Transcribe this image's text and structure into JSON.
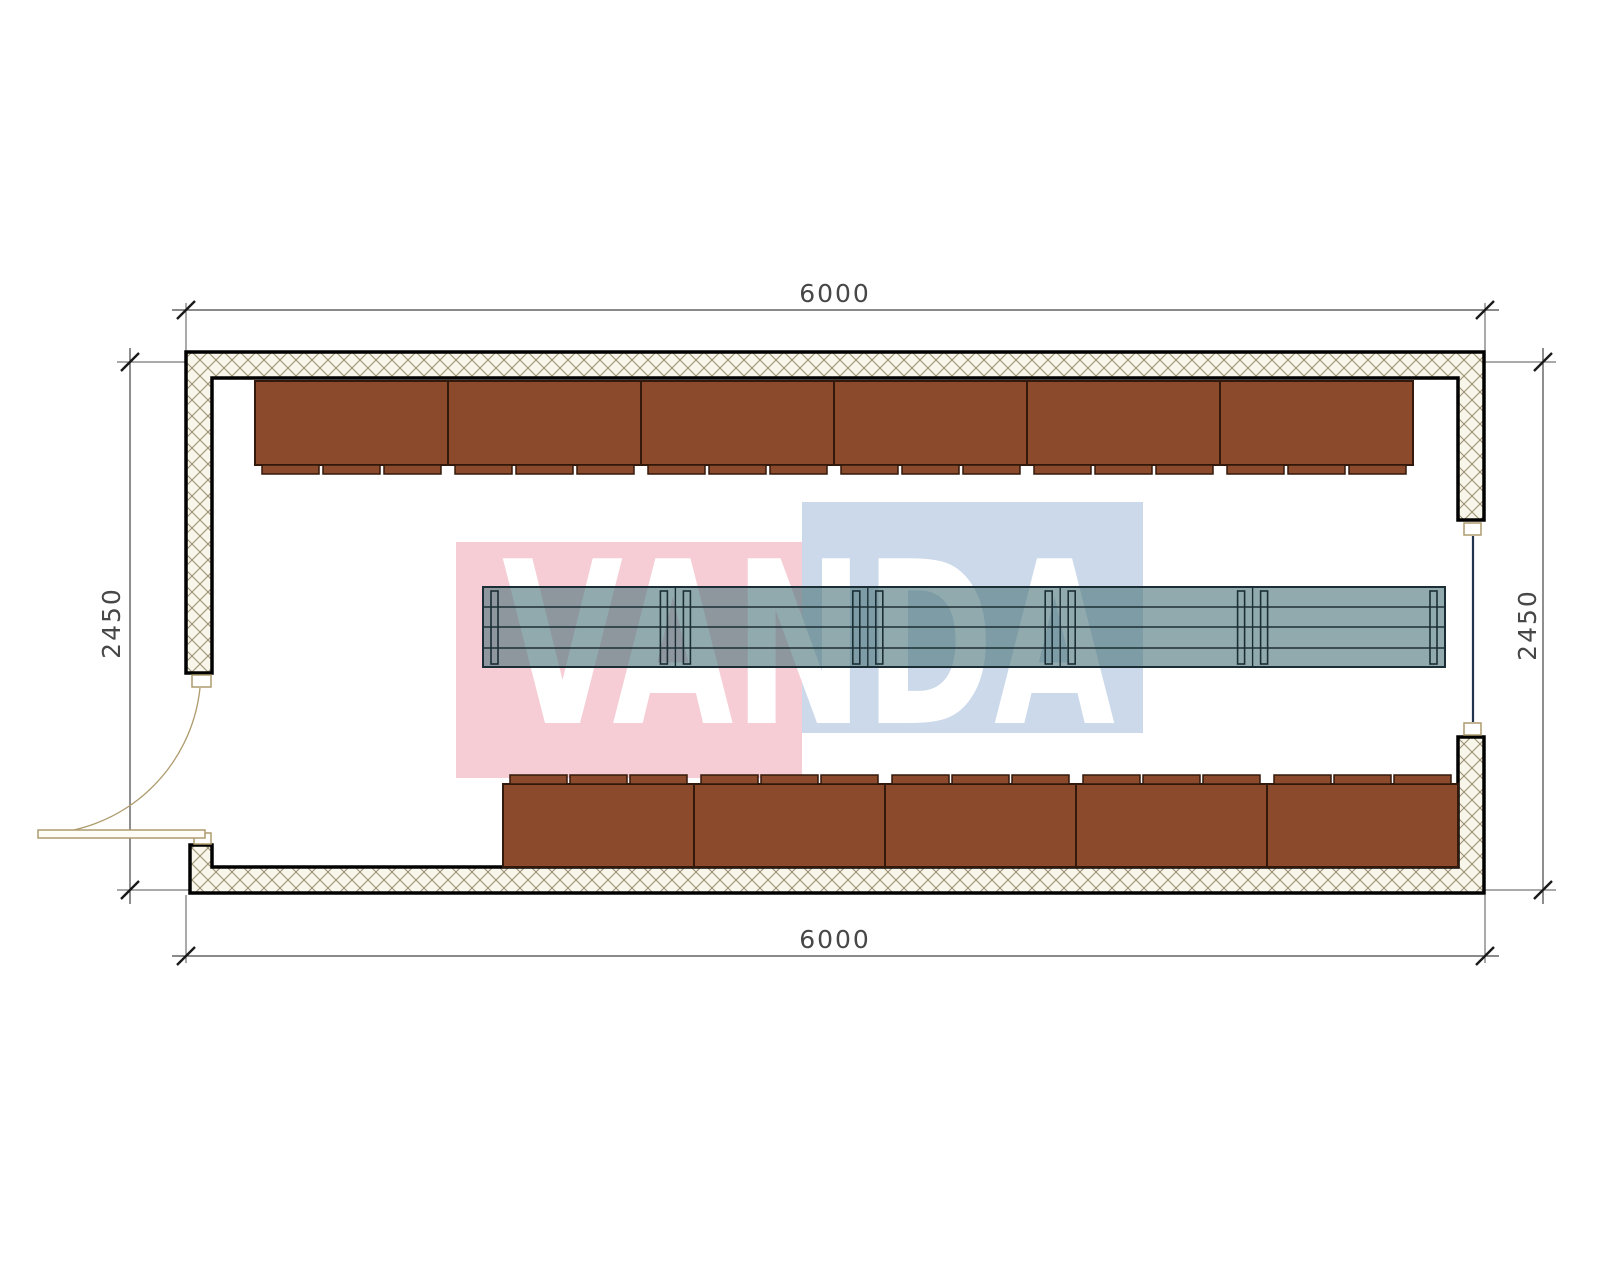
{
  "drawing": {
    "type": "floor-plan",
    "watermark": {
      "text": "VANDA",
      "pink_color": "#F7CDD5",
      "blue_color": "#CBD9EA",
      "text_color": "#FFFFFF"
    },
    "dimensions": {
      "top": "6000",
      "bottom": "6000",
      "left": "2450",
      "right": "2450"
    },
    "furniture": {
      "top_bench_count": 6,
      "bottom_bench_count": 5,
      "tabs_per_bench": 3,
      "table_segment_count": 5,
      "table_planks": 4,
      "bench_color": "#8B4A2C",
      "table_color": "#4D767C"
    },
    "structure": {
      "wall_hatch_color": "#9B9172",
      "wall_outline_color": "#000000",
      "door_color": "#AE9C6E",
      "window_glazing_color": "#22354F"
    }
  }
}
